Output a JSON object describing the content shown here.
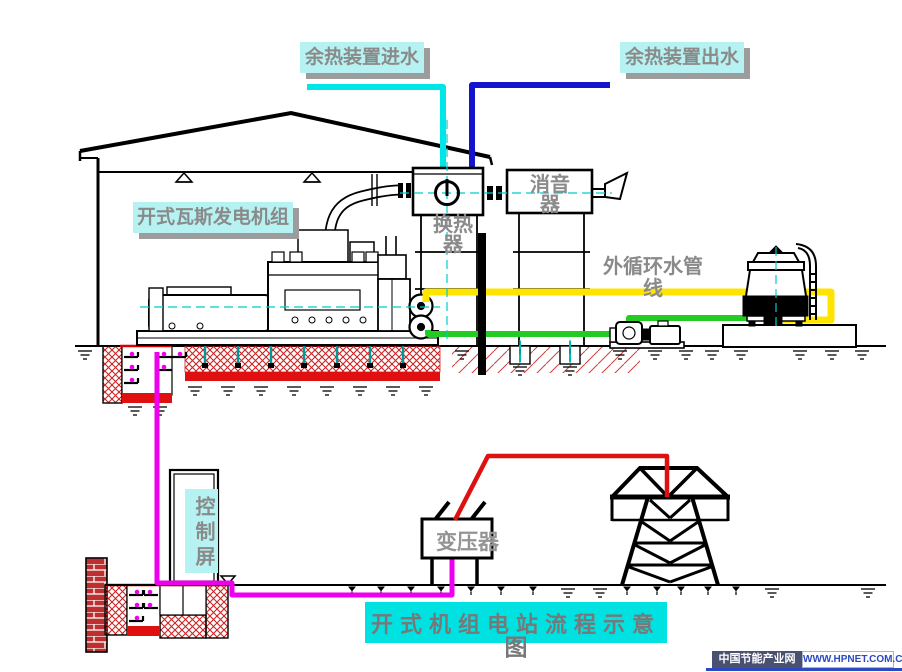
{
  "labels": {
    "inlet": "余热装置进水",
    "outlet": "余热装置出水",
    "genset": "开式瓦斯发电机组",
    "heat_exchanger_l1": "换热",
    "heat_exchanger_l2": "器",
    "muffler_l1": "消音",
    "muffler_l2": "器",
    "ext_pipe_l1": "外循环水管",
    "ext_pipe_l2": "线",
    "control_panel": "控制屏",
    "transformer": "变压器"
  },
  "title": {
    "line1": "开式机组电站流程示意",
    "line2": "图"
  },
  "watermark": {
    "site_name": "中国节能产业网",
    "site_url": "WWW.HPNET.COM.CN"
  },
  "colors": {
    "inlet_pipe": "#00e6e6",
    "outlet_pipe": "#1414cc",
    "circulation_out_pipe": "#ffe400",
    "circulation_return_pipe": "#22cc22",
    "power_cable": "#dd1111",
    "control_cable": "#ee00ee",
    "foundation_hatch": "#cc2222",
    "foundation_band": "#e01010",
    "centerline": "#00cccc",
    "bolt": "#009999",
    "label_bg": "#b6f2f2",
    "title_bg": "#00e2e2",
    "label_text": "#8a8a8a"
  }
}
